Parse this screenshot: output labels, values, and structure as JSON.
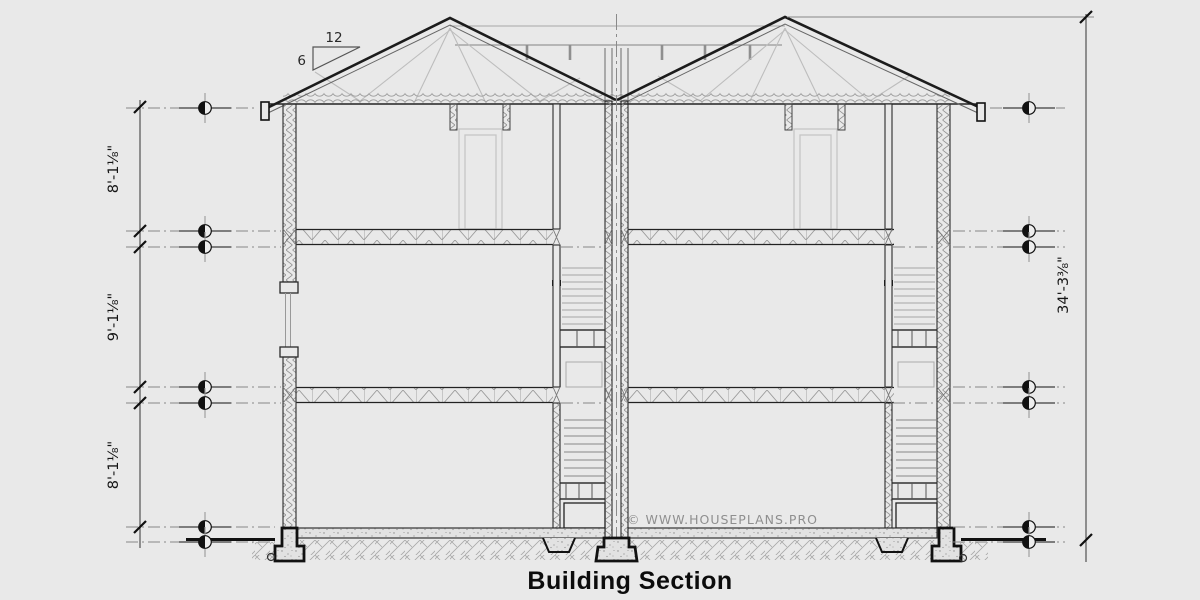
{
  "drawing": {
    "title": "Building Section",
    "watermark": "© WWW.HOUSEPLANS.PRO",
    "pitch": {
      "run": "12",
      "rise": "6"
    },
    "dims": {
      "upper": "8'-1⅛\"",
      "main": "9'-1⅛\"",
      "lower": "8'-1⅛\"",
      "overall": "34'-3⅜\""
    },
    "colors": {
      "background": "#e9e9e9",
      "line": "#1a1a1a",
      "light_line": "#b3b3b3",
      "watermark_gray": "#8f8f8f"
    }
  }
}
